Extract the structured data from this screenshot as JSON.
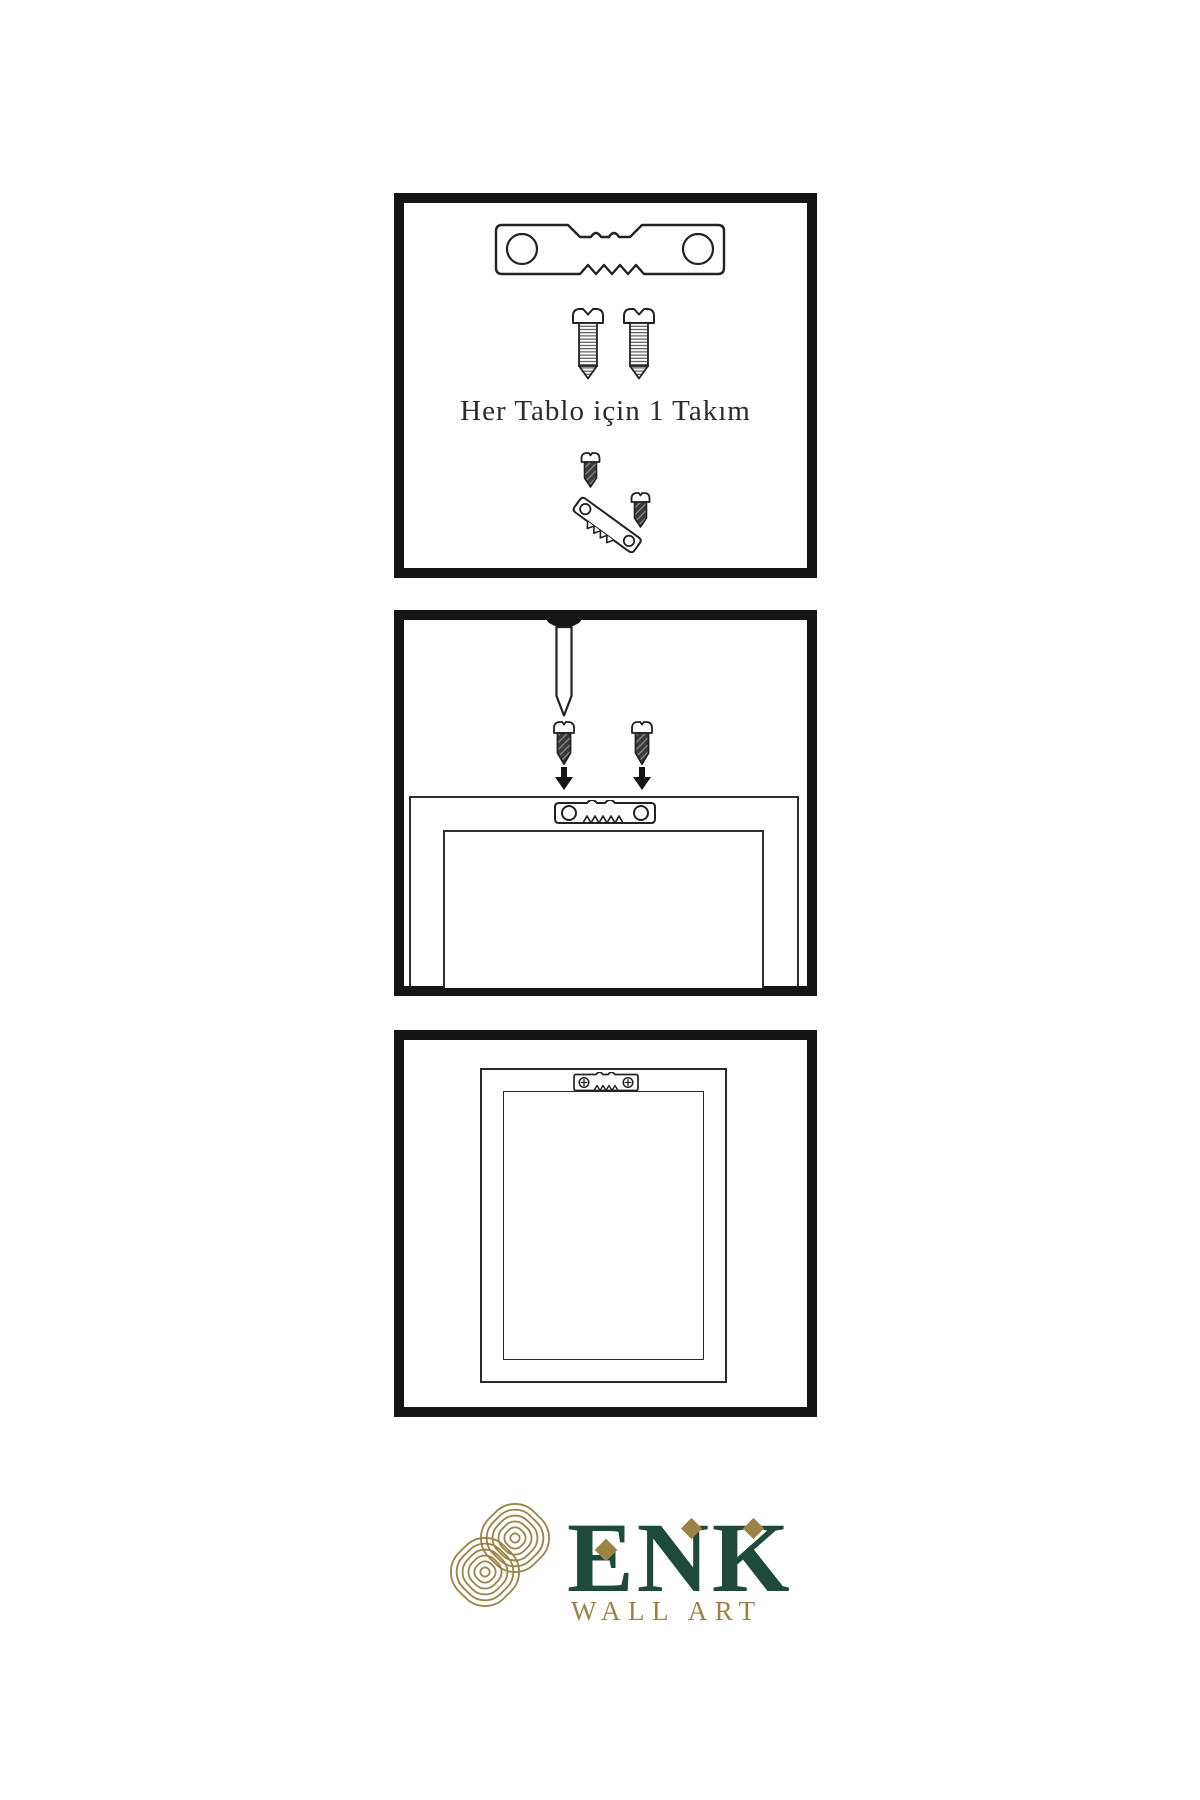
{
  "background": "#ffffff",
  "colors": {
    "line": "#222222",
    "panel_border": "#141414",
    "dark_screw_fill": "#3a3a3a",
    "brand_green": "#1d4a39",
    "brand_gold": "#9b8345"
  },
  "step1": {
    "caption": "Her Tablo için 1 Takım",
    "icons": {
      "hanger": "sawtooth-hanger-icon",
      "screw_left": "screw-icon",
      "screw_right": "screw-icon",
      "assembly": "screw-into-hanger-icon"
    }
  },
  "step2": {
    "icons": {
      "nail": "nail-icon",
      "screw_left": "screw-down-arrow-icon",
      "screw_right": "screw-down-arrow-icon",
      "frame": "frame-back-with-hanger-icon",
      "hanger": "sawtooth-hanger-icon"
    }
  },
  "step3": {
    "icons": {
      "frame": "hung-frame-icon",
      "hanger": "mounted-sawtooth-hanger-icon"
    }
  },
  "brand": {
    "name": "ENK",
    "subtitle": "WALL ART",
    "emblem": "knot-emblem-icon"
  }
}
